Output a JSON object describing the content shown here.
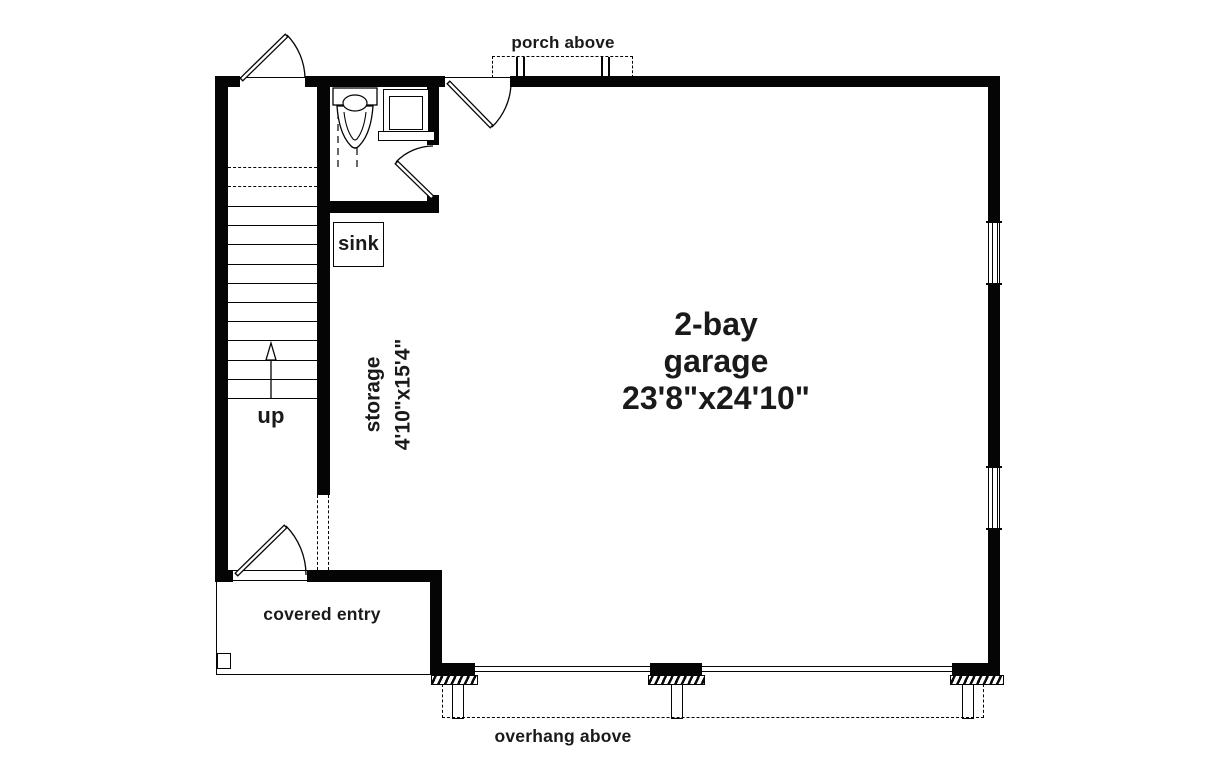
{
  "document": {
    "type": "floor plan drawing",
    "colors": {
      "wall": "#050505",
      "text": "#1a1a1a",
      "background": "#ffffff"
    },
    "labels": {
      "porch": "porch above",
      "sink": "sink",
      "stairs_up": "up",
      "storage": {
        "name": "storage",
        "dims": "4'10\"x15'4\""
      },
      "garage": {
        "line1": "2-bay",
        "line2": "garage",
        "dims": "23'8\"x24'10\""
      },
      "entry": "covered entry",
      "overhang": "overhang above"
    },
    "rooms": [
      {
        "name": "2-bay garage",
        "dimensions": "23'8\"x24'10\""
      },
      {
        "name": "storage",
        "dimensions": "4'10\"x15'4\""
      }
    ]
  }
}
